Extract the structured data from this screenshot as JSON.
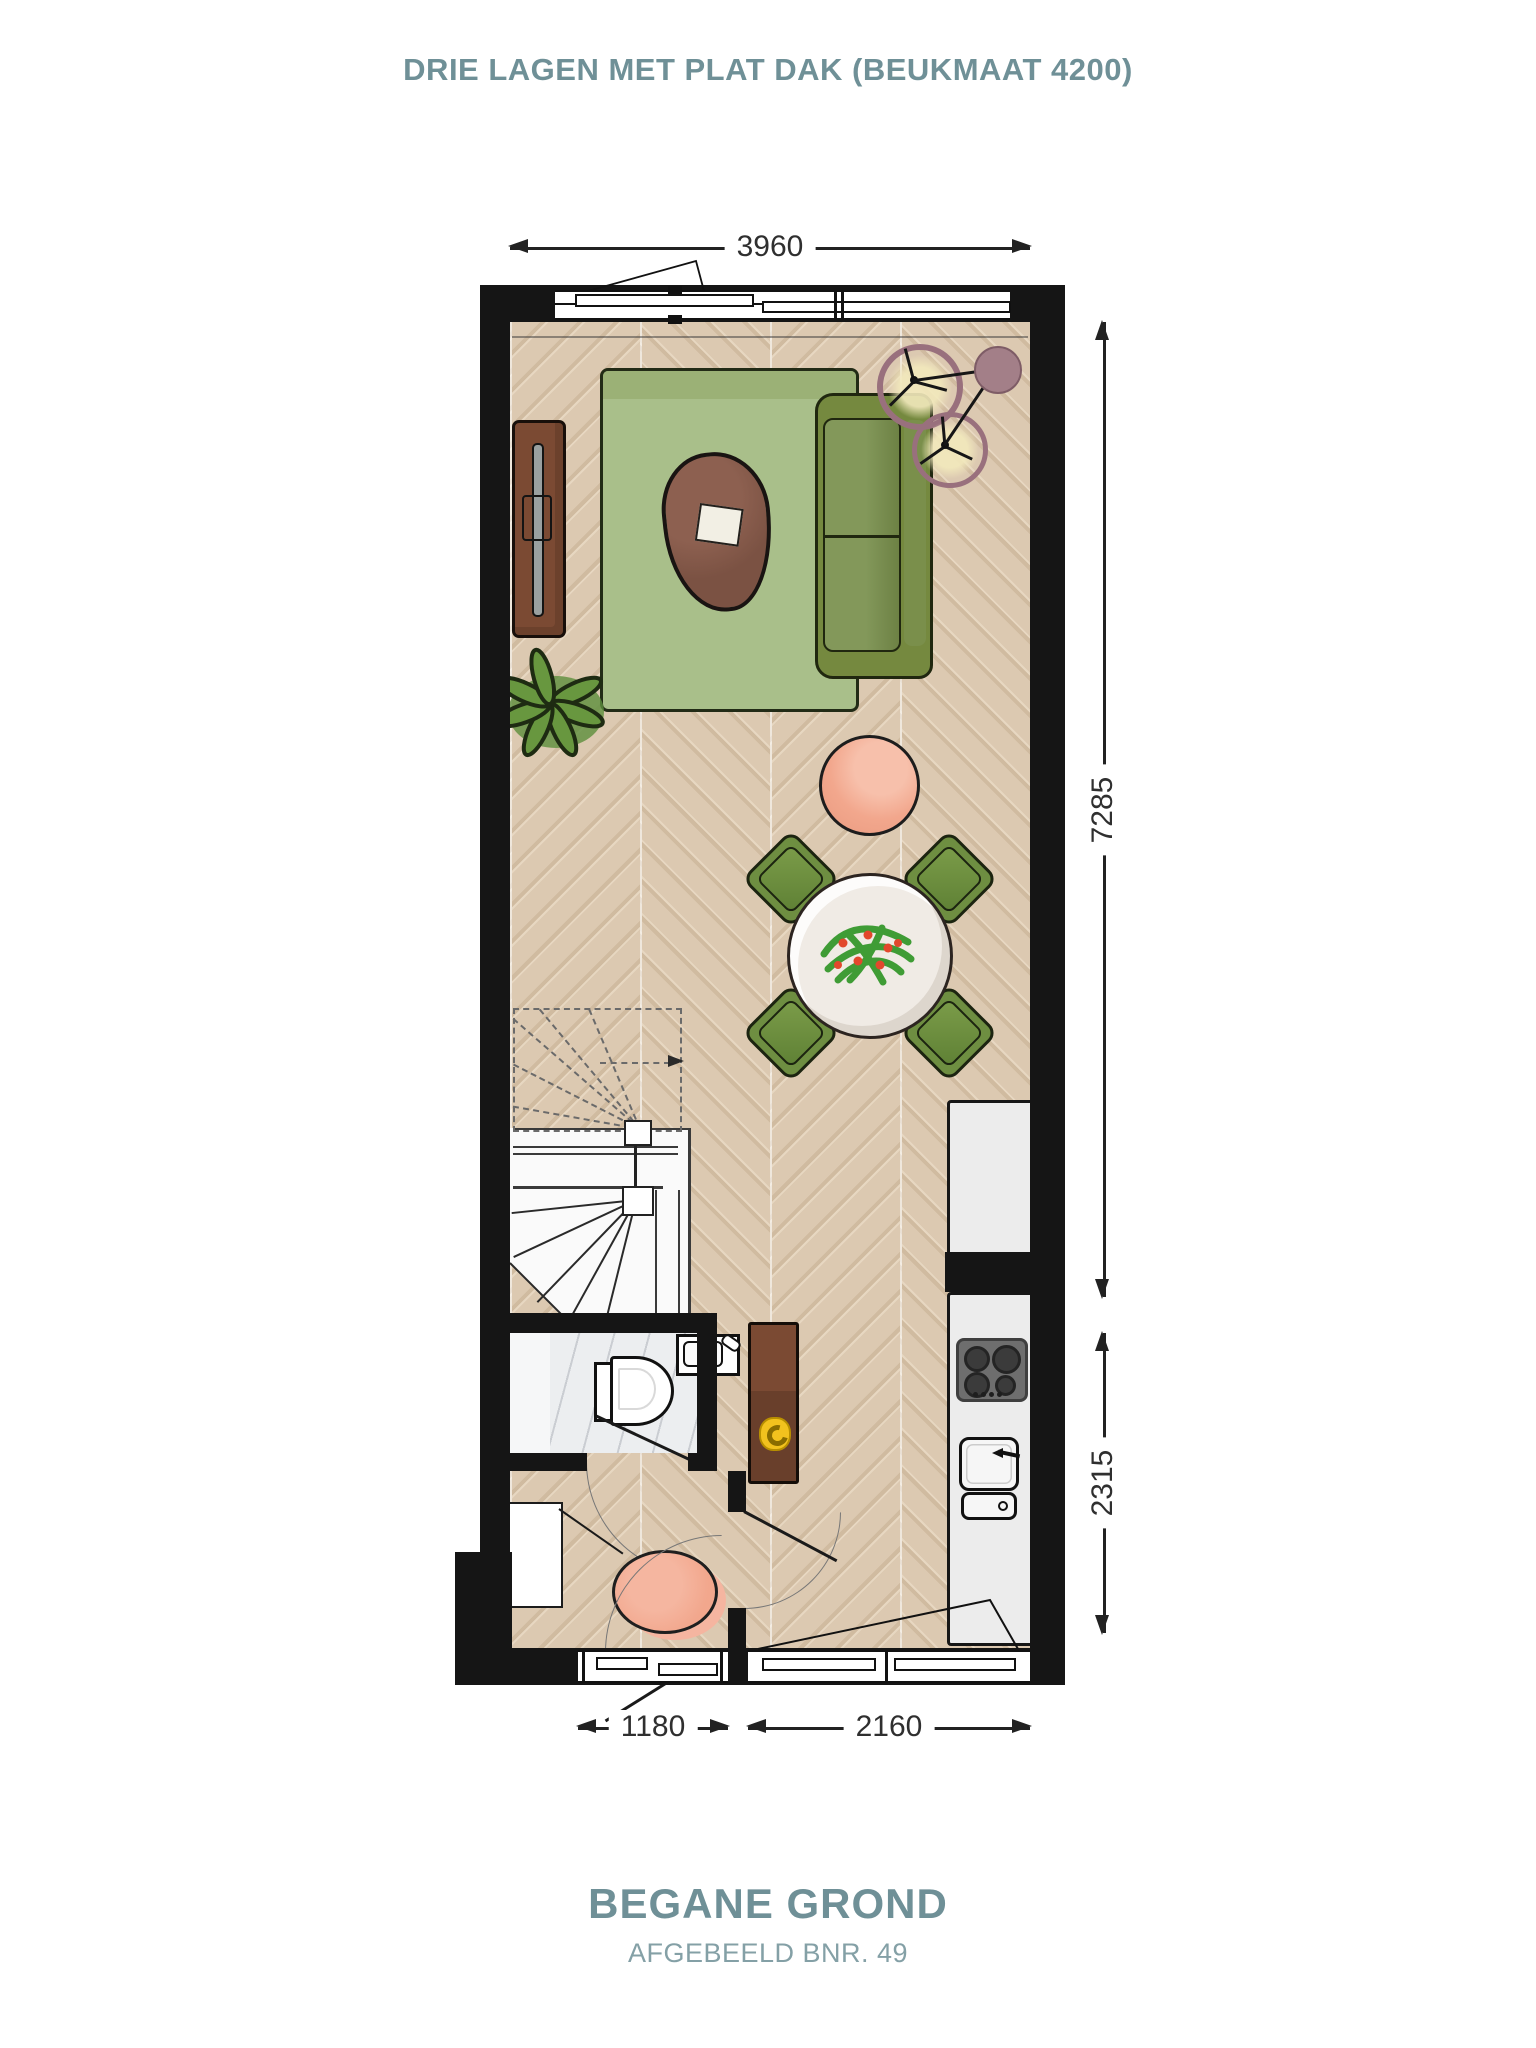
{
  "title": "DRIE LAGEN MET PLAT DAK (BEUKMAAT 4200)",
  "footer": {
    "title": "BEGANE GROND",
    "subtitle": "AFGEBEELD BNR. 49"
  },
  "dimensions": {
    "top_width": "3960",
    "right_upper_height": "7285",
    "right_lower_height": "2315",
    "bottom_left_width": "1180",
    "bottom_right_width": "2160"
  },
  "colors": {
    "accent_teal": "#6f9097",
    "wall_black": "#151515",
    "floor_wood": "#d9c6ae",
    "rug_green": "#a9bf8a",
    "sofa_green": "#7d9150",
    "chair_green": "#6e8e41",
    "coffee_table_brown": "#7b5243",
    "pouf_salmon": "#f2a78d",
    "hall_cabinet_brown": "#7b4a33",
    "counter_gray": "#ececec",
    "bathroom_marble": "#eceef0",
    "lamp_mauve": "#a37f88",
    "accent_yellow": "#f2c21e"
  },
  "icons": [
    "sofa-icon",
    "rug-icon",
    "coffee-table-icon",
    "pouf-icon",
    "floor-lamp-icon",
    "tv-sideboard-icon",
    "plant-icon",
    "dining-table-icon",
    "dining-chair-icon",
    "spiral-stairs-icon",
    "toilet-icon",
    "sink-icon",
    "cooktop-icon",
    "kitchen-sink-icon",
    "cabinet-icon",
    "doormat-icon",
    "door-icon",
    "window-icon"
  ]
}
